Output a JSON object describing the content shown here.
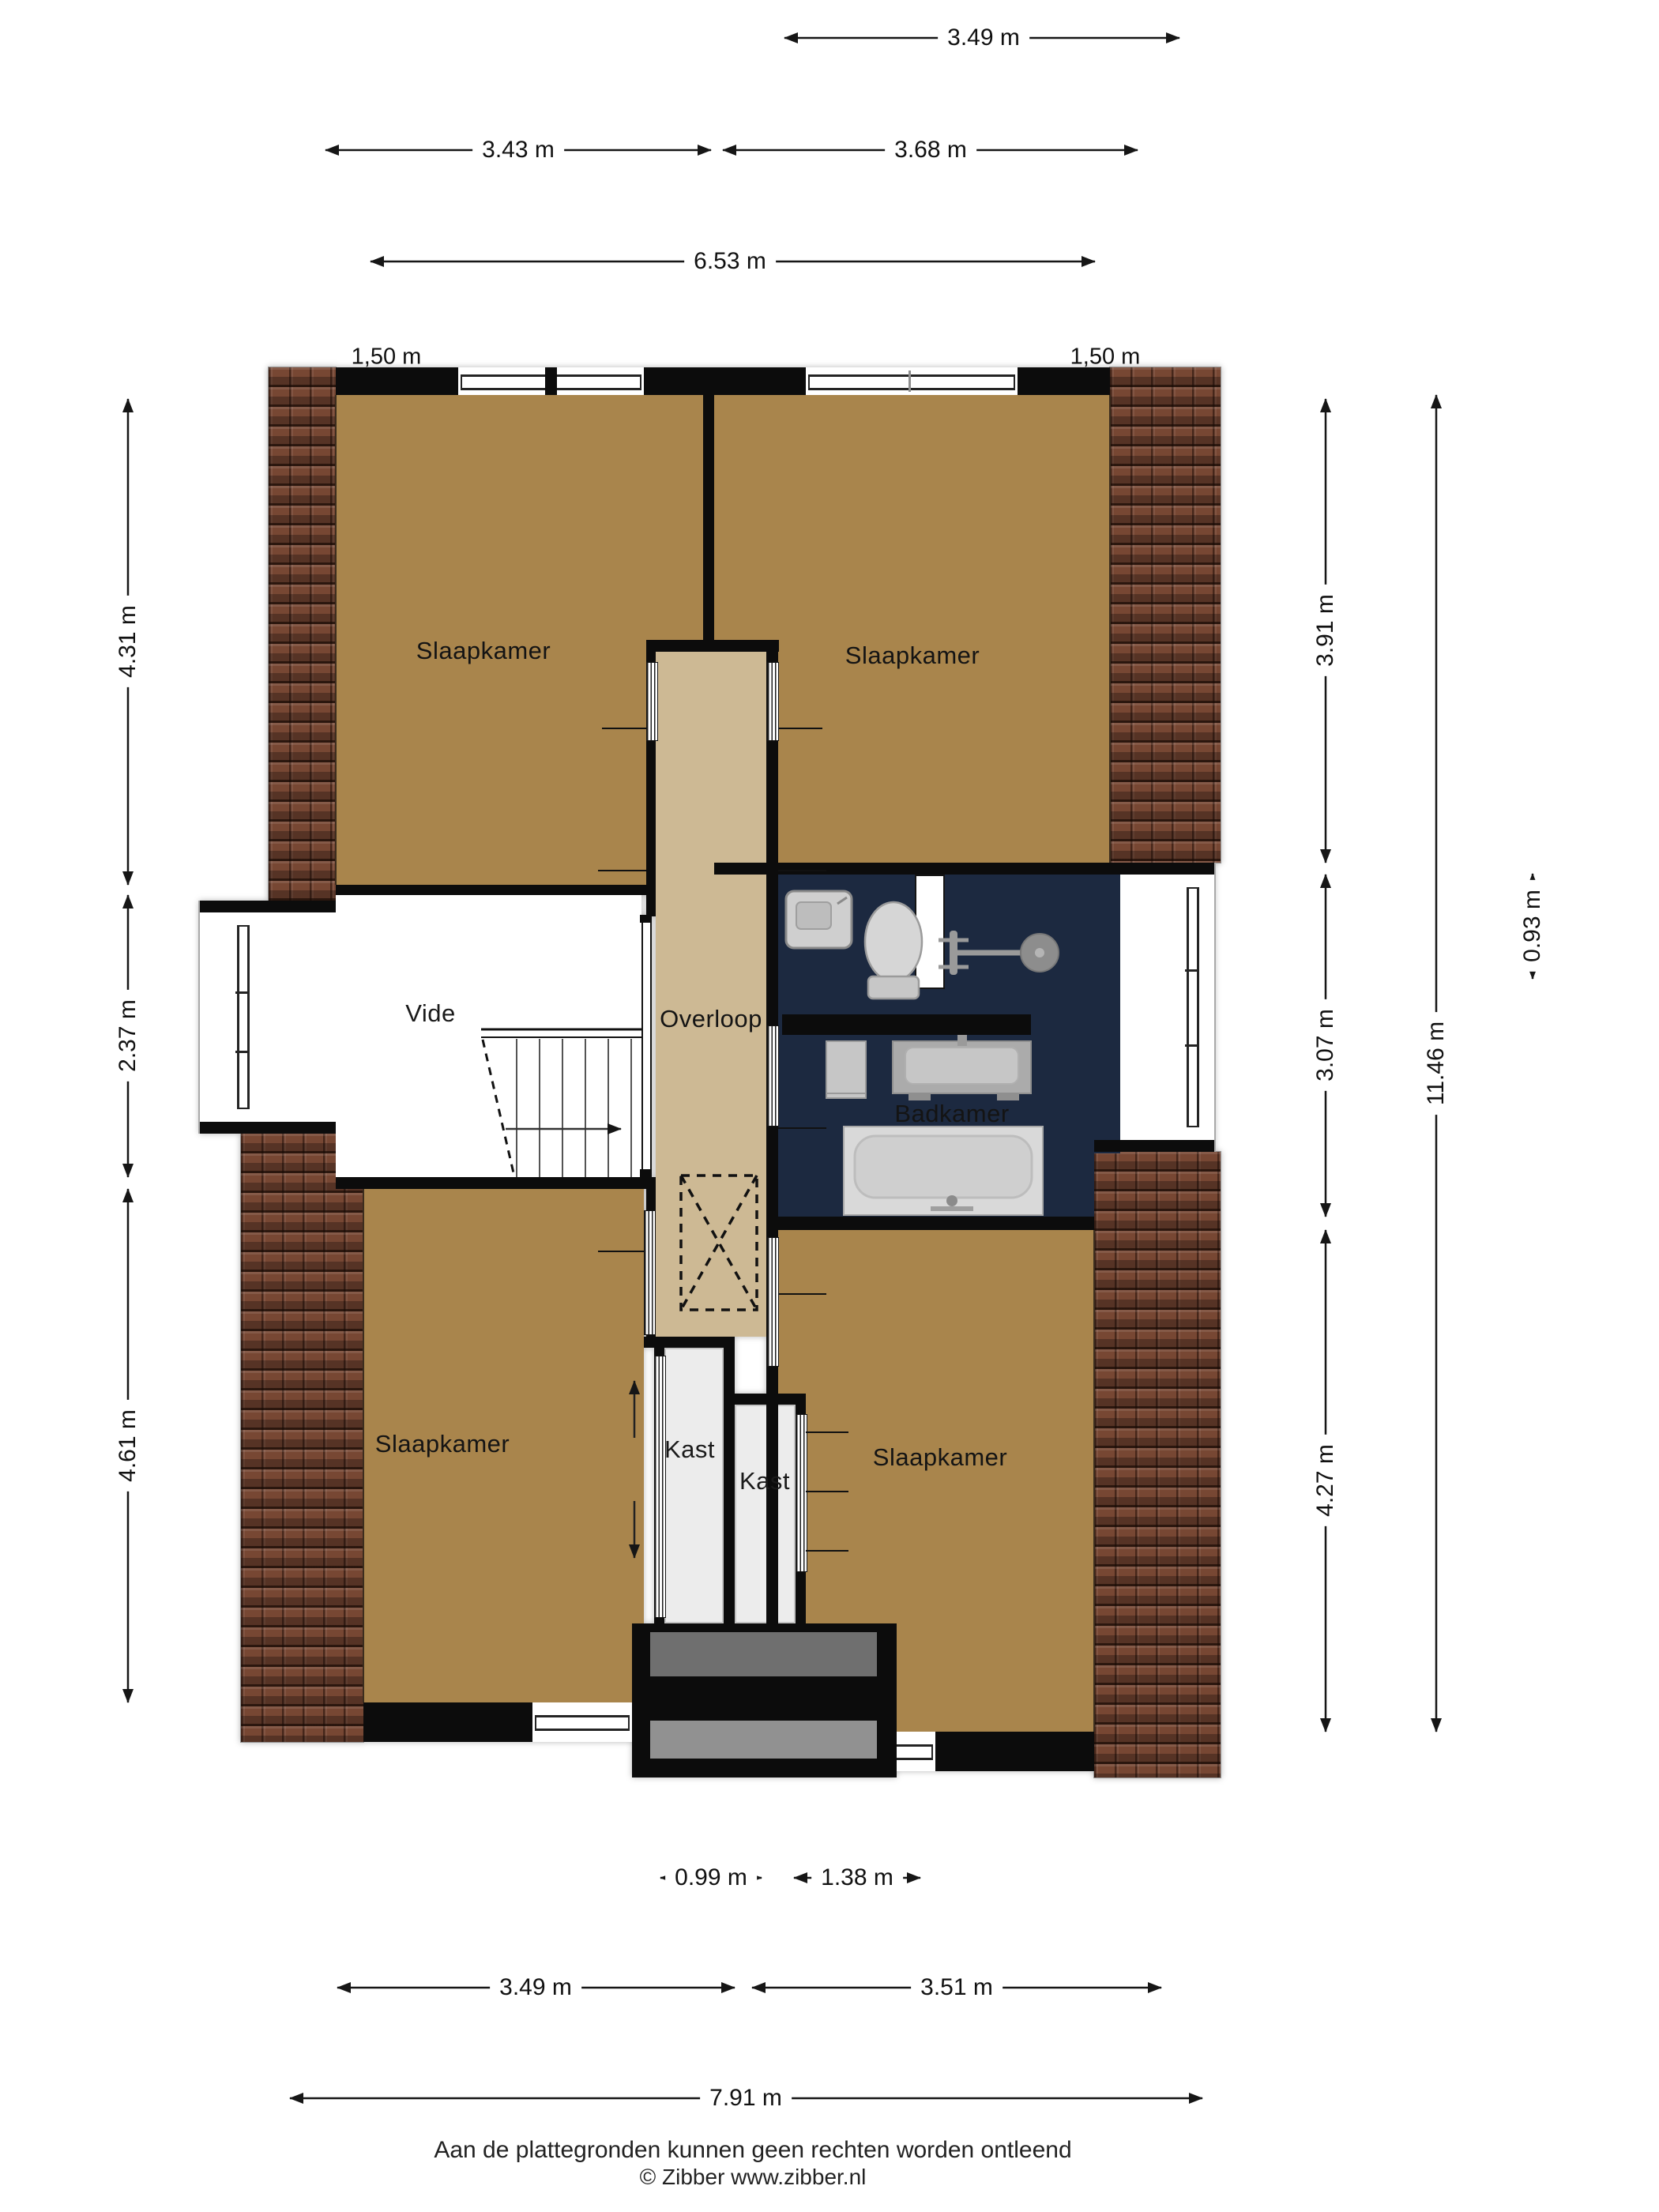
{
  "rooms": {
    "slaapkamer_tl": "Slaapkamer",
    "slaapkamer_tr": "Slaapkamer",
    "vide": "Vide",
    "overloop": "Overloop",
    "badkamer": "Badkamer",
    "slaapkamer_bl": "Slaapkamer",
    "slaapkamer_br": "Slaapkamer",
    "kast_left": "Kast",
    "kast_right": "Kast"
  },
  "dimensions": {
    "top": [
      "3.49 m",
      "3.43 m",
      "3.68 m",
      "6.53 m"
    ],
    "knee": [
      "1,50 m",
      "1,50 m"
    ],
    "left": [
      "4.31 m",
      "2.37 m",
      "4.61 m"
    ],
    "right": [
      "3.91 m",
      "3.07 m",
      "4.27 m",
      "11.46 m",
      "0.93 m"
    ],
    "bottom": [
      "0.99 m",
      "1.38 m",
      "3.49 m",
      "3.51 m",
      "7.91 m"
    ]
  },
  "footer": {
    "disclaimer": "Aan de plattegronden kunnen geen rechten worden ontleend",
    "copyright": "© Zibber www.zibber.nl"
  },
  "colors": {
    "bedroom_floor": "#A9854C",
    "hall_floor": "#CDB994",
    "bathroom_floor": "#1C2940",
    "closet_floor": "#ECECEC",
    "wall": "#0C0C0C",
    "roof_tiles": "#774733"
  }
}
